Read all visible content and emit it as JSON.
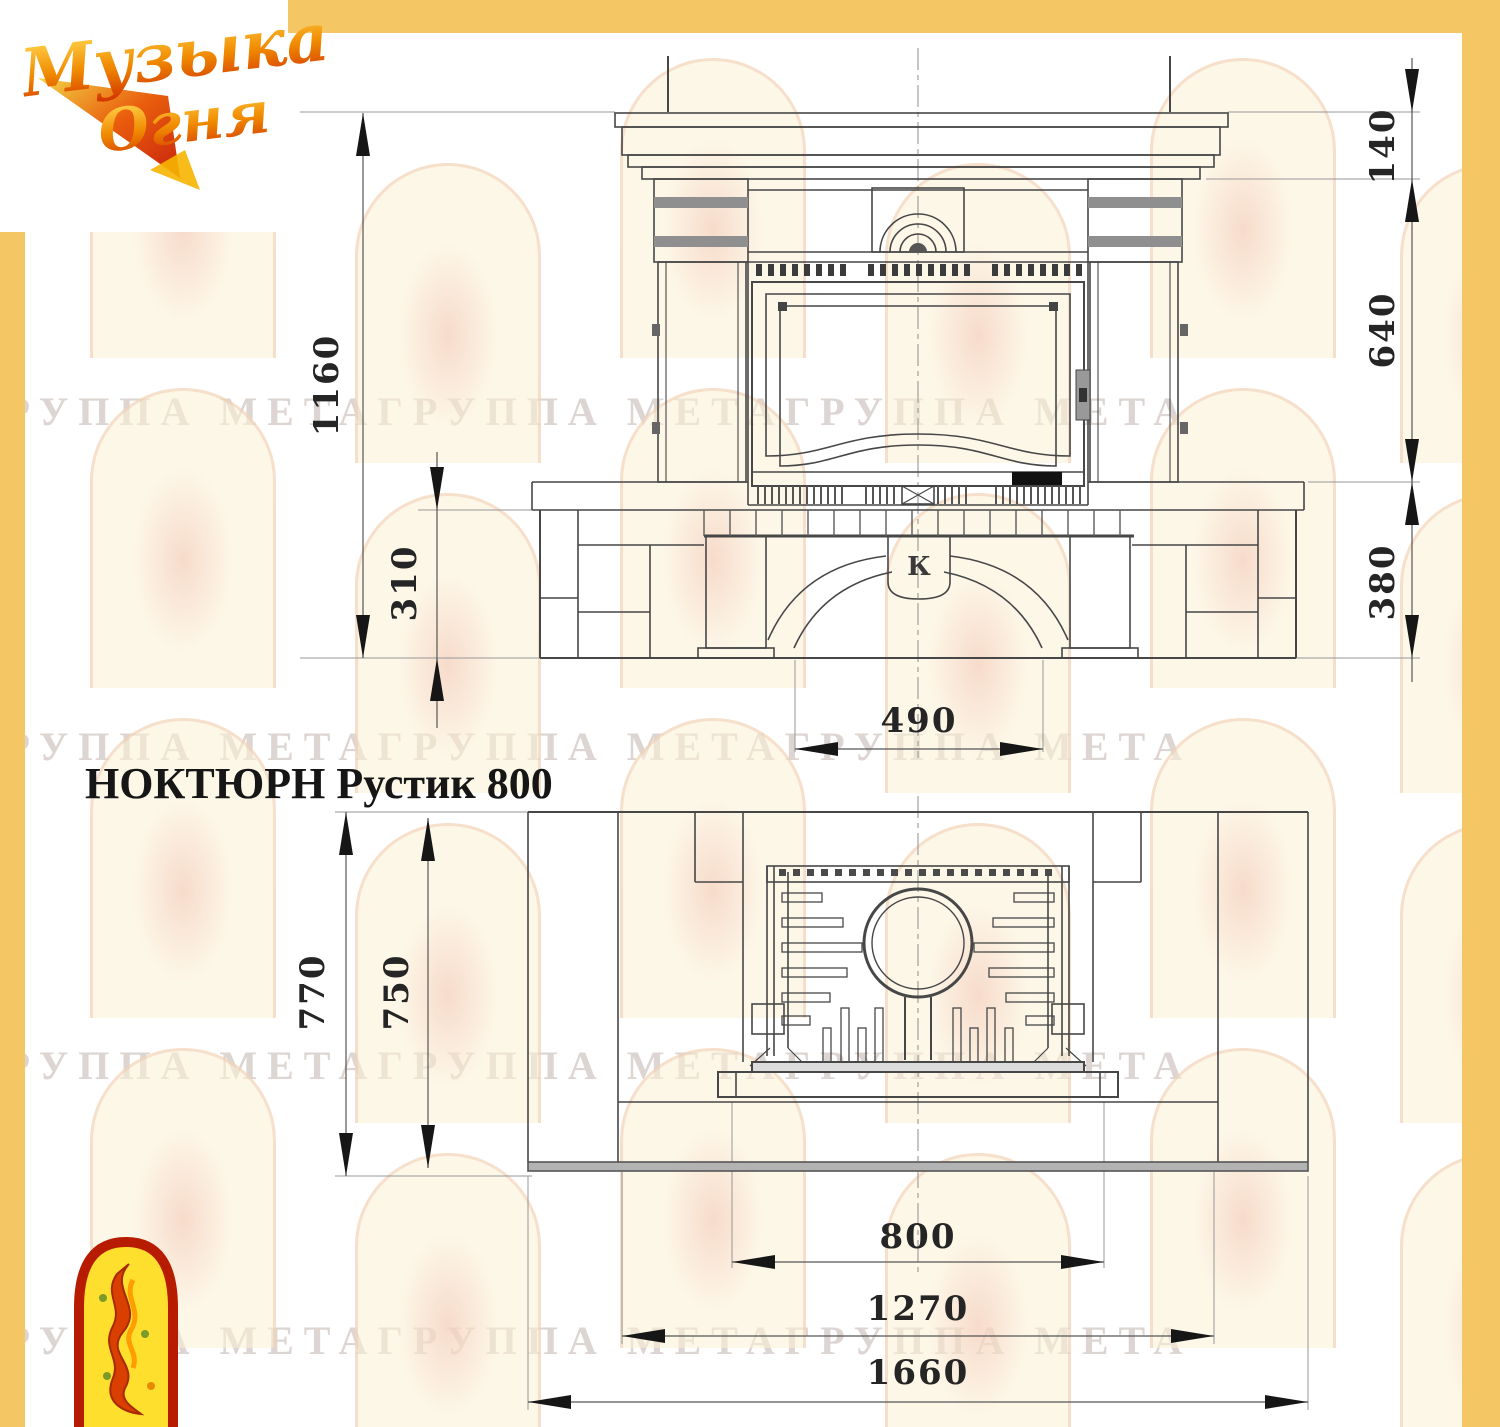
{
  "colors": {
    "accent_yellow": "#f4c664",
    "line_gray": "#474747",
    "logo_red": "#c22000"
  },
  "brand": {
    "word1": "Музыка",
    "word2": "Огня"
  },
  "watermark": {
    "text": "ГРУППА МЕТАГРУППА МЕТАГРУППА МЕТА"
  },
  "drawing": {
    "title": "НОКТЮРН Рустик 800",
    "front_view": {
      "keystone_mark": "К",
      "dims": {
        "total_height": "1160",
        "base_height": "310",
        "shelf_band_height": "140",
        "opening_zone_height": "640",
        "hearth_zone_height": "380",
        "opening_width": "490"
      }
    },
    "plan_view": {
      "dims": {
        "outer_depth": "770",
        "inner_depth": "750",
        "firebox_width": "800",
        "hearth_width": "1270",
        "overall_width": "1660"
      }
    }
  }
}
